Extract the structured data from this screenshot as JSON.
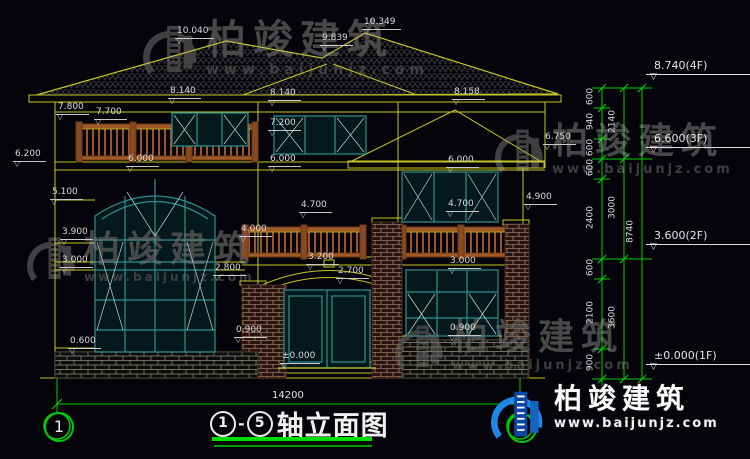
{
  "title": {
    "circle_start": "1",
    "circle_end": "5",
    "separator": "-",
    "text": "轴立面图"
  },
  "axes": {
    "left": "1",
    "right": "5"
  },
  "overall_dim": "14200",
  "brand": {
    "name": "柏竣建筑",
    "url": "www.baijunjz.com"
  },
  "colors": {
    "line_yellow": "#c6c623",
    "dim_green": "#00cc00",
    "window_teal": "#2f8f8f",
    "railing_brown": "#9c5526",
    "brick_red": "#2b1410",
    "logo_blue": "#1e88e5",
    "background": "#04040a",
    "text": "#d9d9d9"
  },
  "annotations": {
    "dims": [
      {
        "t": "10.040",
        "x": 175,
        "y": 27
      },
      {
        "t": "9.839",
        "x": 320,
        "y": 34
      },
      {
        "t": "10.349",
        "x": 362,
        "y": 18
      },
      {
        "t": "8.140",
        "x": 168,
        "y": 87
      },
      {
        "t": "8.140",
        "x": 268,
        "y": 89
      },
      {
        "t": "8.158",
        "x": 452,
        "y": 88
      },
      {
        "t": "7.800",
        "x": 56,
        "y": 103
      },
      {
        "t": "7.700",
        "x": 94,
        "y": 108
      },
      {
        "t": "7.200",
        "x": 268,
        "y": 119
      },
      {
        "t": "6.750",
        "x": 543,
        "y": 133
      },
      {
        "t": "6.200",
        "x": 13,
        "y": 150
      },
      {
        "t": "6.000",
        "x": 126,
        "y": 155
      },
      {
        "t": "6.000",
        "x": 268,
        "y": 155
      },
      {
        "t": "6.000",
        "x": 446,
        "y": 156
      },
      {
        "t": "5.100",
        "x": 50,
        "y": 188
      },
      {
        "t": "4.900",
        "x": 524,
        "y": 193
      },
      {
        "t": "4.700",
        "x": 299,
        "y": 201
      },
      {
        "t": "4.700",
        "x": 446,
        "y": 200
      },
      {
        "t": "4.000",
        "x": 239,
        "y": 225
      },
      {
        "t": "3.900",
        "x": 60,
        "y": 228
      },
      {
        "t": "3.200",
        "x": 306,
        "y": 253
      },
      {
        "t": "3.000",
        "x": 60,
        "y": 256
      },
      {
        "t": "3.000",
        "x": 448,
        "y": 257
      },
      {
        "t": "2.800",
        "x": 213,
        "y": 264
      },
      {
        "t": "2.700",
        "x": 336,
        "y": 267
      },
      {
        "t": "0.900",
        "x": 234,
        "y": 326
      },
      {
        "t": "0.900",
        "x": 448,
        "y": 324
      },
      {
        "t": "0.600",
        "x": 68,
        "y": 337
      },
      {
        "t": "±0.000",
        "x": 280,
        "y": 352
      }
    ],
    "chain": {
      "levels": [
        {
          "t": "8.740(4F)",
          "x": 646,
          "y": 60
        },
        {
          "t": "6.600(3F)",
          "x": 646,
          "y": 133
        },
        {
          "t": "3.600(2F)",
          "x": 646,
          "y": 230
        },
        {
          "t": "±0.000(1F)",
          "x": 646,
          "y": 350
        }
      ],
      "segments": [
        {
          "t": "600",
          "x": 591,
          "y": 98
        },
        {
          "t": "940",
          "x": 591,
          "y": 123
        },
        {
          "t": "600",
          "x": 591,
          "y": 149
        },
        {
          "t": "600",
          "x": 591,
          "y": 169
        },
        {
          "t": "2400",
          "x": 591,
          "y": 219
        },
        {
          "t": "600",
          "x": 591,
          "y": 269
        },
        {
          "t": "2100",
          "x": 591,
          "y": 314
        },
        {
          "t": "900",
          "x": 591,
          "y": 364
        },
        {
          "t": "2140",
          "x": 613,
          "y": 123
        },
        {
          "t": "3000",
          "x": 613,
          "y": 209
        },
        {
          "t": "3600",
          "x": 613,
          "y": 319
        },
        {
          "t": "8740",
          "x": 631,
          "y": 233
        }
      ]
    }
  }
}
